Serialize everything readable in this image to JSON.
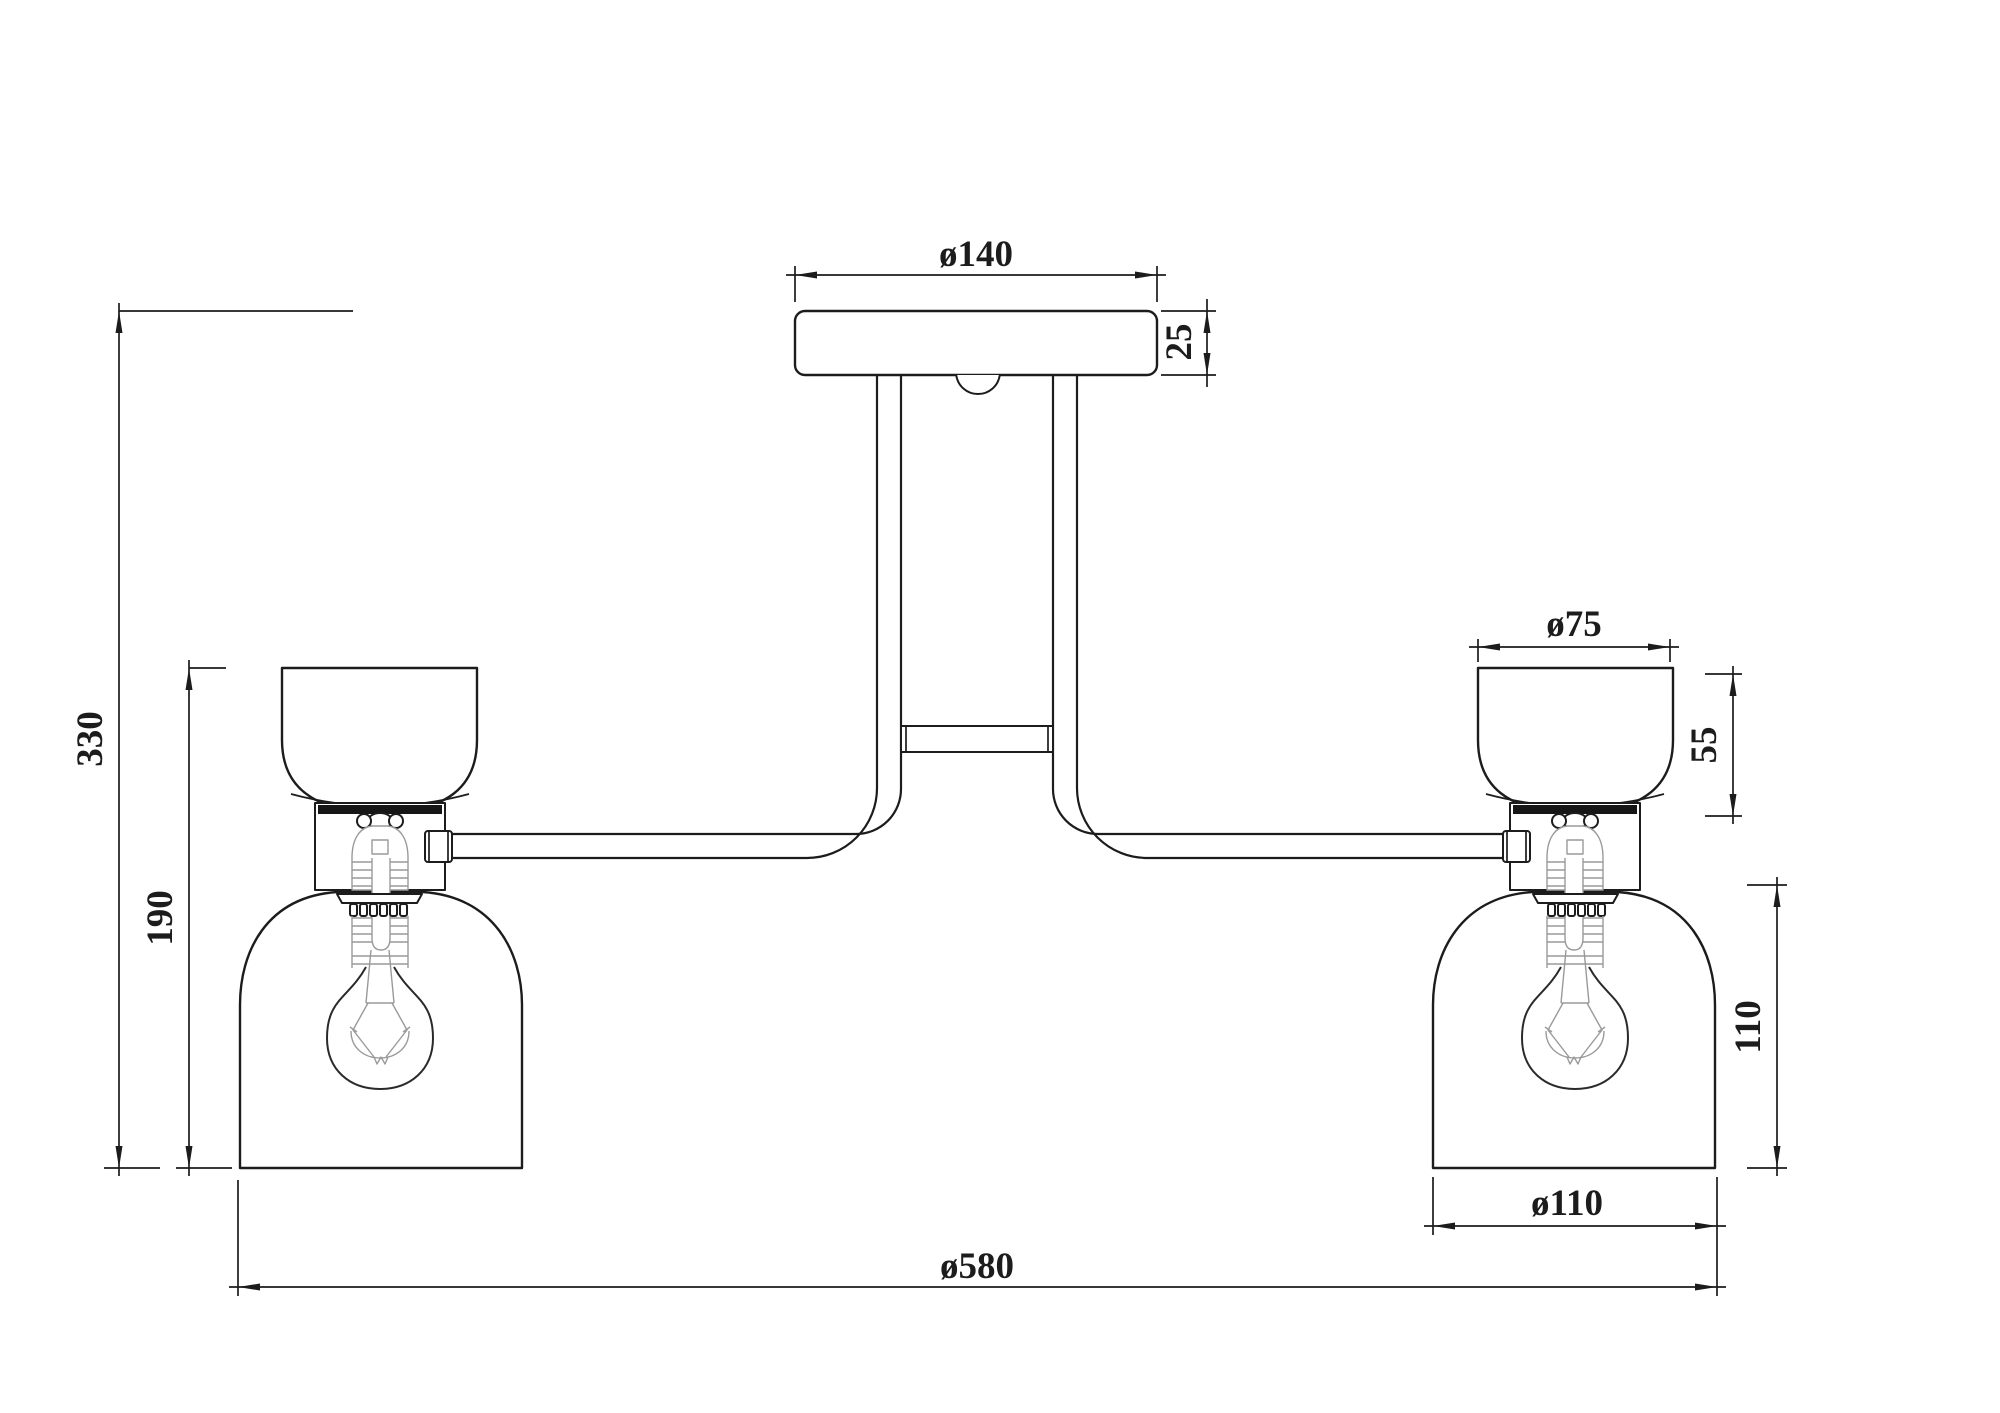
{
  "drawing": {
    "type": "technical-dimension-drawing",
    "subject": "two-light semi-flush ceiling fixture with glass shades",
    "dimensions": {
      "canopy_diameter": "ø140",
      "canopy_thickness": "25",
      "overall_height": "330",
      "lamp_height": "190",
      "upper_shade_diameter": "ø75",
      "upper_shade_height": "55",
      "lower_shade_height": "110",
      "lower_shade_diameter": "ø110",
      "overall_width": "ø580"
    },
    "colors": {
      "line": "#1c1c1c",
      "detail_line": "#9a9a9a",
      "background": "#ffffff"
    }
  }
}
